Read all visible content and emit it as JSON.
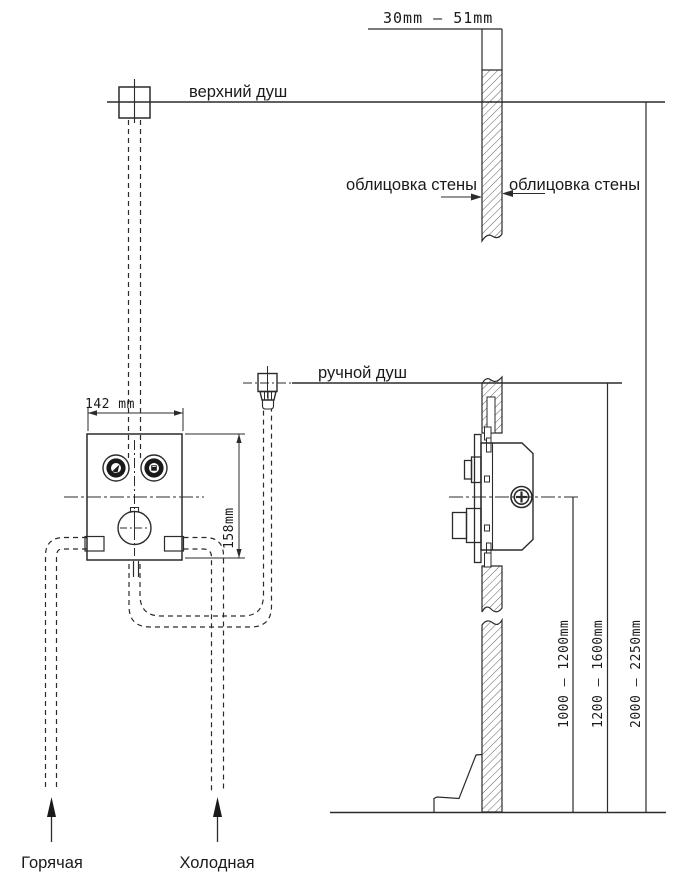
{
  "colors": {
    "line": "#2b2b2b",
    "text": "#1a1a1a",
    "hatch": "#4d4d4d",
    "background": "#ffffff"
  },
  "labels": {
    "wall_depth_range": "30mm — 51mm",
    "overhead_shower": "верхний душ",
    "wall_cladding_left": "облицовка стены",
    "wall_cladding_right": "облицовка стены",
    "hand_shower": "ручной душ",
    "panel_width": "142 mm",
    "panel_height": "158mm",
    "valve_mount_height": "1000 — 1200mm",
    "hand_shower_height": "1200 — 1600mm",
    "overhead_shower_height": "2000 — 2250mm",
    "hot_water": "Горячая",
    "cold_water": "Холодная"
  }
}
